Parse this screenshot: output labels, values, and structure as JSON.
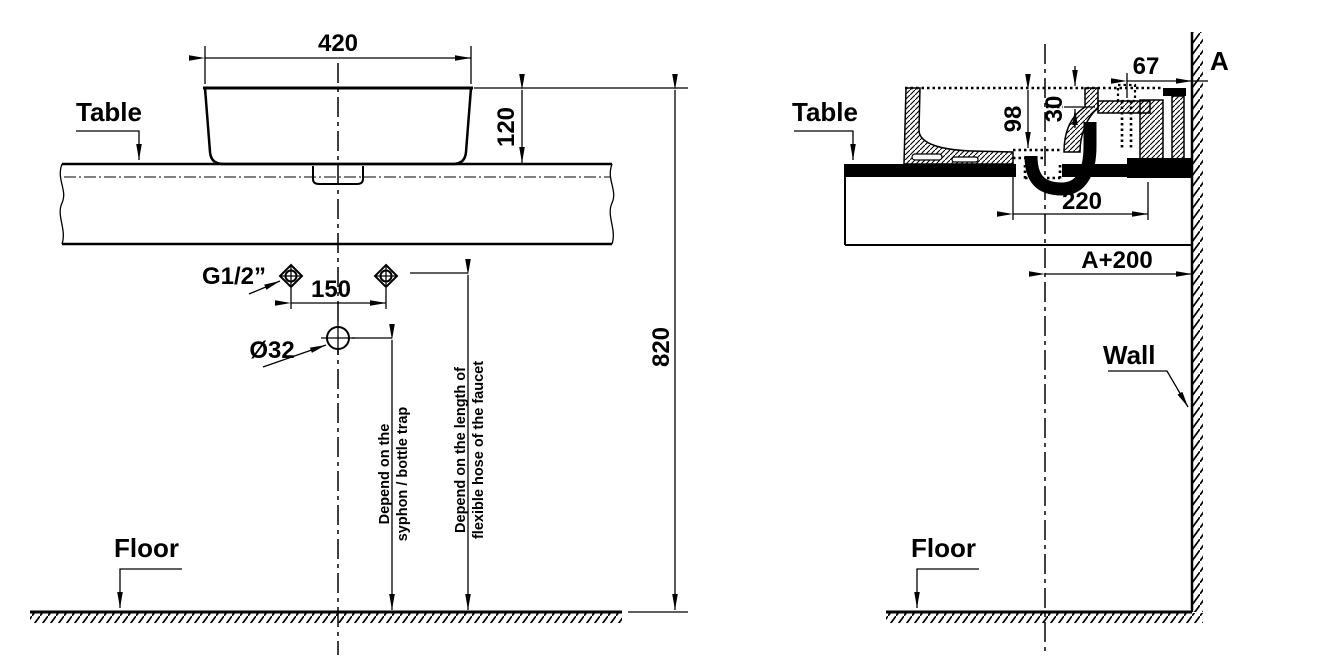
{
  "front_view": {
    "table_label": "Table",
    "floor_label": "Floor",
    "faucet_thread": "G1/2”",
    "drain_diameter": "Ø32",
    "dims": {
      "width": "420",
      "basin_height": "120",
      "rim_height": "820",
      "faucet_spacing": "150"
    },
    "drain_note_line1": "Depend on the",
    "drain_note_line2": "syphon / bottle trap",
    "faucet_note_line1": "Depend on the length of",
    "faucet_note_line2": "flexible hose of the faucet"
  },
  "side_view": {
    "table_label": "Table",
    "floor_label": "Floor",
    "wall_label": "Wall",
    "section_label": "A",
    "dims": {
      "rim_to_wall": "67",
      "bowl_depth": "98",
      "rim_to_deck": "30",
      "drain_to_back": "220",
      "center_to_wall": "A+200"
    }
  },
  "colors": {
    "line": "#000000",
    "background": "#ffffff"
  }
}
